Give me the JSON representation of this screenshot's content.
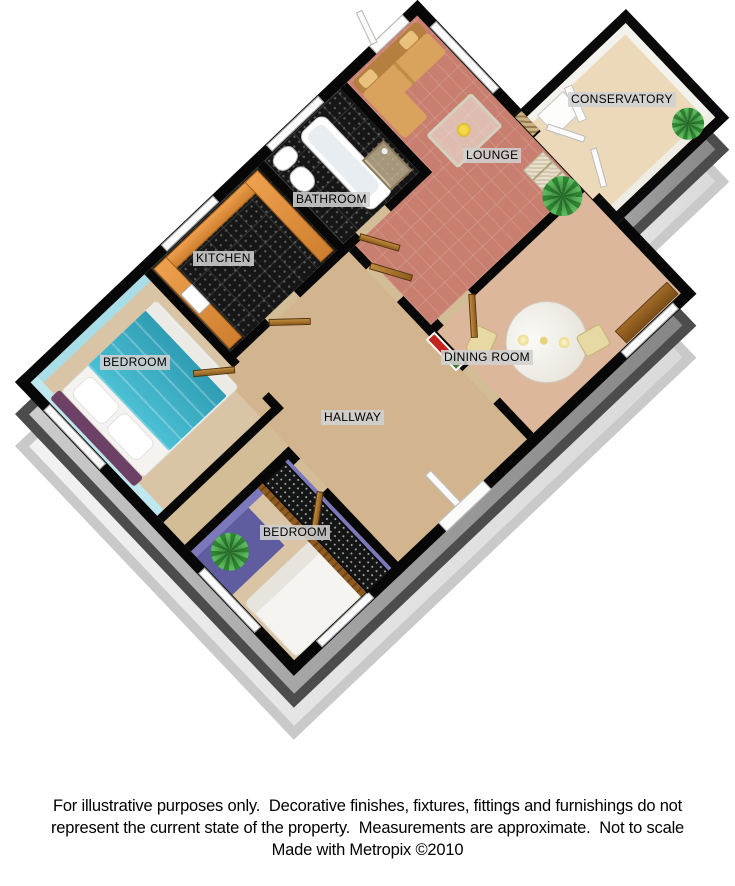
{
  "plan": {
    "type": "3d-floor-plan",
    "maker": "Metropix"
  },
  "rooms": [
    {
      "id": "conservatory",
      "label": "CONSERVATORY"
    },
    {
      "id": "lounge",
      "label": "LOUNGE"
    },
    {
      "id": "bathroom",
      "label": "BATHROOM"
    },
    {
      "id": "kitchen",
      "label": "KITCHEN"
    },
    {
      "id": "bedroom-1",
      "label": "BEDROOM"
    },
    {
      "id": "dining-room",
      "label": "DINING ROOM"
    },
    {
      "id": "hallway",
      "label": "HALLWAY"
    },
    {
      "id": "bedroom-2",
      "label": "BEDROOM"
    }
  ],
  "footer": {
    "line1": "For illustrative purposes only.  Decorative finishes, fixtures, fittings and furnishings do not",
    "line2": "represent the current state of the property.  Measurements are approximate.  Not to scale",
    "line3": "Made with Metropix ©2010"
  },
  "colors": {
    "wall_outline": "#070707",
    "floor_tan": "#d3bd97",
    "carpet_salmon": "#c87f6f",
    "floor_dark_tile": "#161616",
    "bedroom1_wall_cyan": "#bfe8ee",
    "bedroom2_wall_purple": "#7b78bb",
    "bedroom2_rug_indigo": "#5f5da0",
    "bed_headboard_purple": "#6d4166",
    "bed_throw_teal": "#3fb0c4",
    "kitchen_counter_orange": "#e0883a",
    "sofa_tan": "#d9a35e",
    "conservatory_floor": "#ecd9ba",
    "extrusion_grey": "#8a8a8a",
    "label_background": "#d0d0d0"
  }
}
